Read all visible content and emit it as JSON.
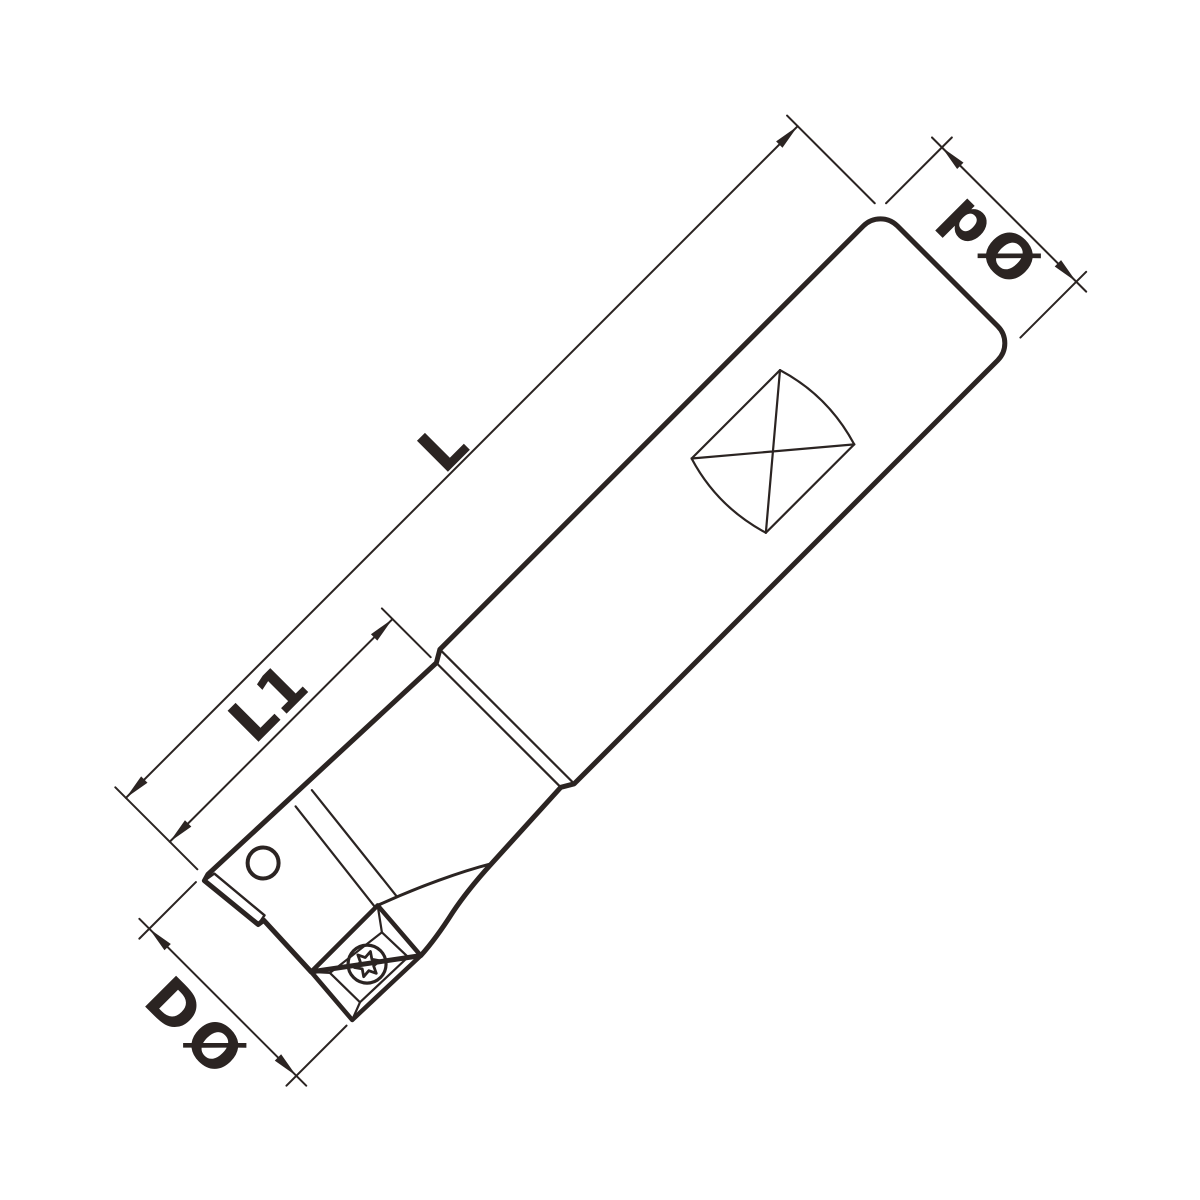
{
  "drawing": {
    "kind": "technical-drawing-end-mill",
    "dimensions": {
      "overall_length_label": "L",
      "head_length_label": "L1",
      "shank_diameter_label": "pØ",
      "cutting_diameter_label": "DØ"
    },
    "colors": {
      "line": "#2b2422",
      "body_fill": "#ececec",
      "insert_fill": "#ffe400",
      "detail_fill": "#ffffff",
      "background": "#ffffff"
    }
  }
}
